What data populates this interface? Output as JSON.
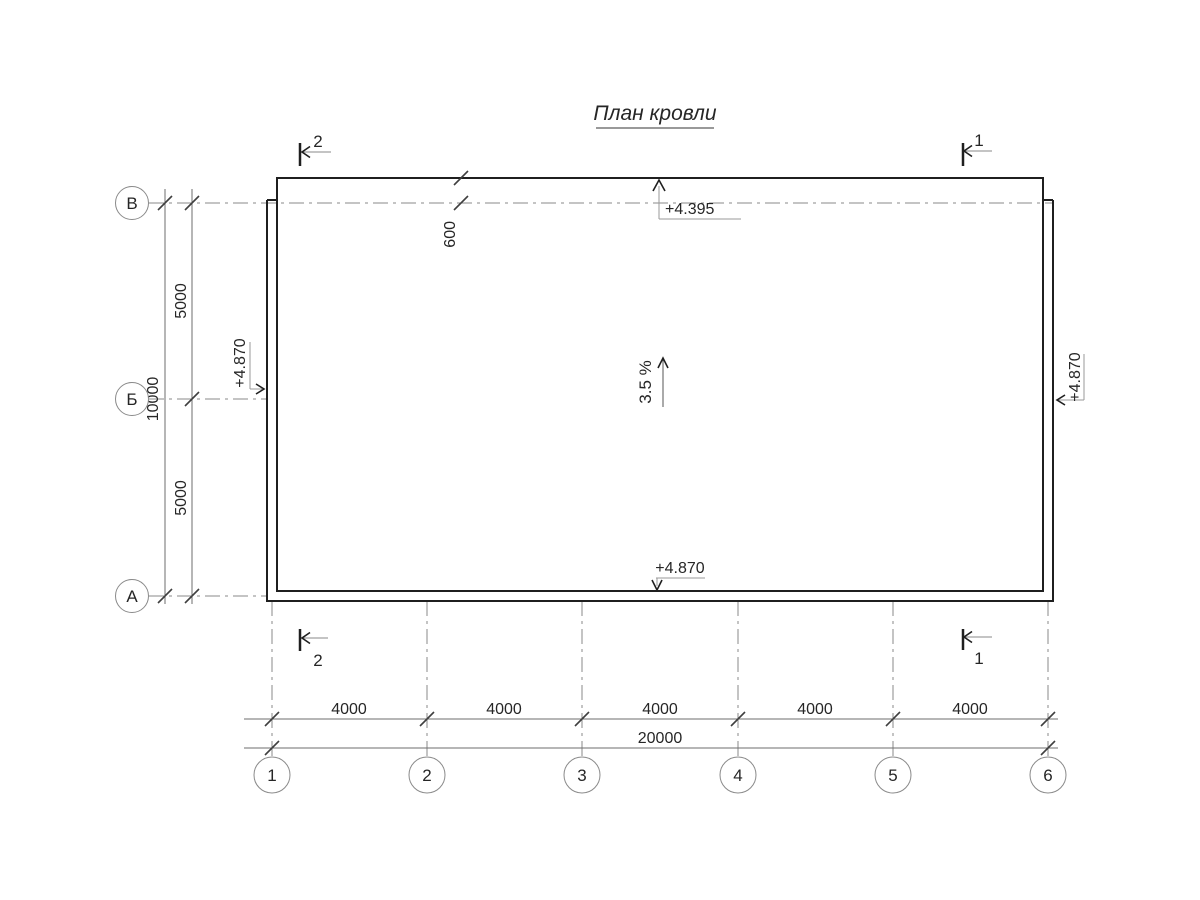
{
  "title": "План кровли",
  "axes": {
    "rows": [
      {
        "label": "В"
      },
      {
        "label": "Б"
      },
      {
        "label": "А"
      }
    ],
    "cols": [
      {
        "label": "1"
      },
      {
        "label": "2"
      },
      {
        "label": "3"
      },
      {
        "label": "4"
      },
      {
        "label": "5"
      },
      {
        "label": "6"
      }
    ]
  },
  "dims": {
    "left_total": "10000",
    "left_segments": [
      "5000",
      "5000"
    ],
    "bottom_total": "20000",
    "bottom_segments": [
      "4000",
      "4000",
      "4000",
      "4000",
      "4000"
    ],
    "eave_offset": "600"
  },
  "elevations": {
    "top_edge": "+4.395",
    "bottom_edge": "+4.870",
    "left_edge": "+4.870",
    "right_edge": "+4.870"
  },
  "slope": {
    "label": "3.5 %"
  },
  "section_marks": {
    "top_left": "2",
    "top_right": "1",
    "bottom_left": "2",
    "bottom_right": "1"
  },
  "colors": {
    "background": "#ffffff",
    "building_line": "#1f1f1f",
    "dimension_line": "#6e6e6e",
    "axis_line": "#8a8a8a",
    "text": "#262626"
  }
}
